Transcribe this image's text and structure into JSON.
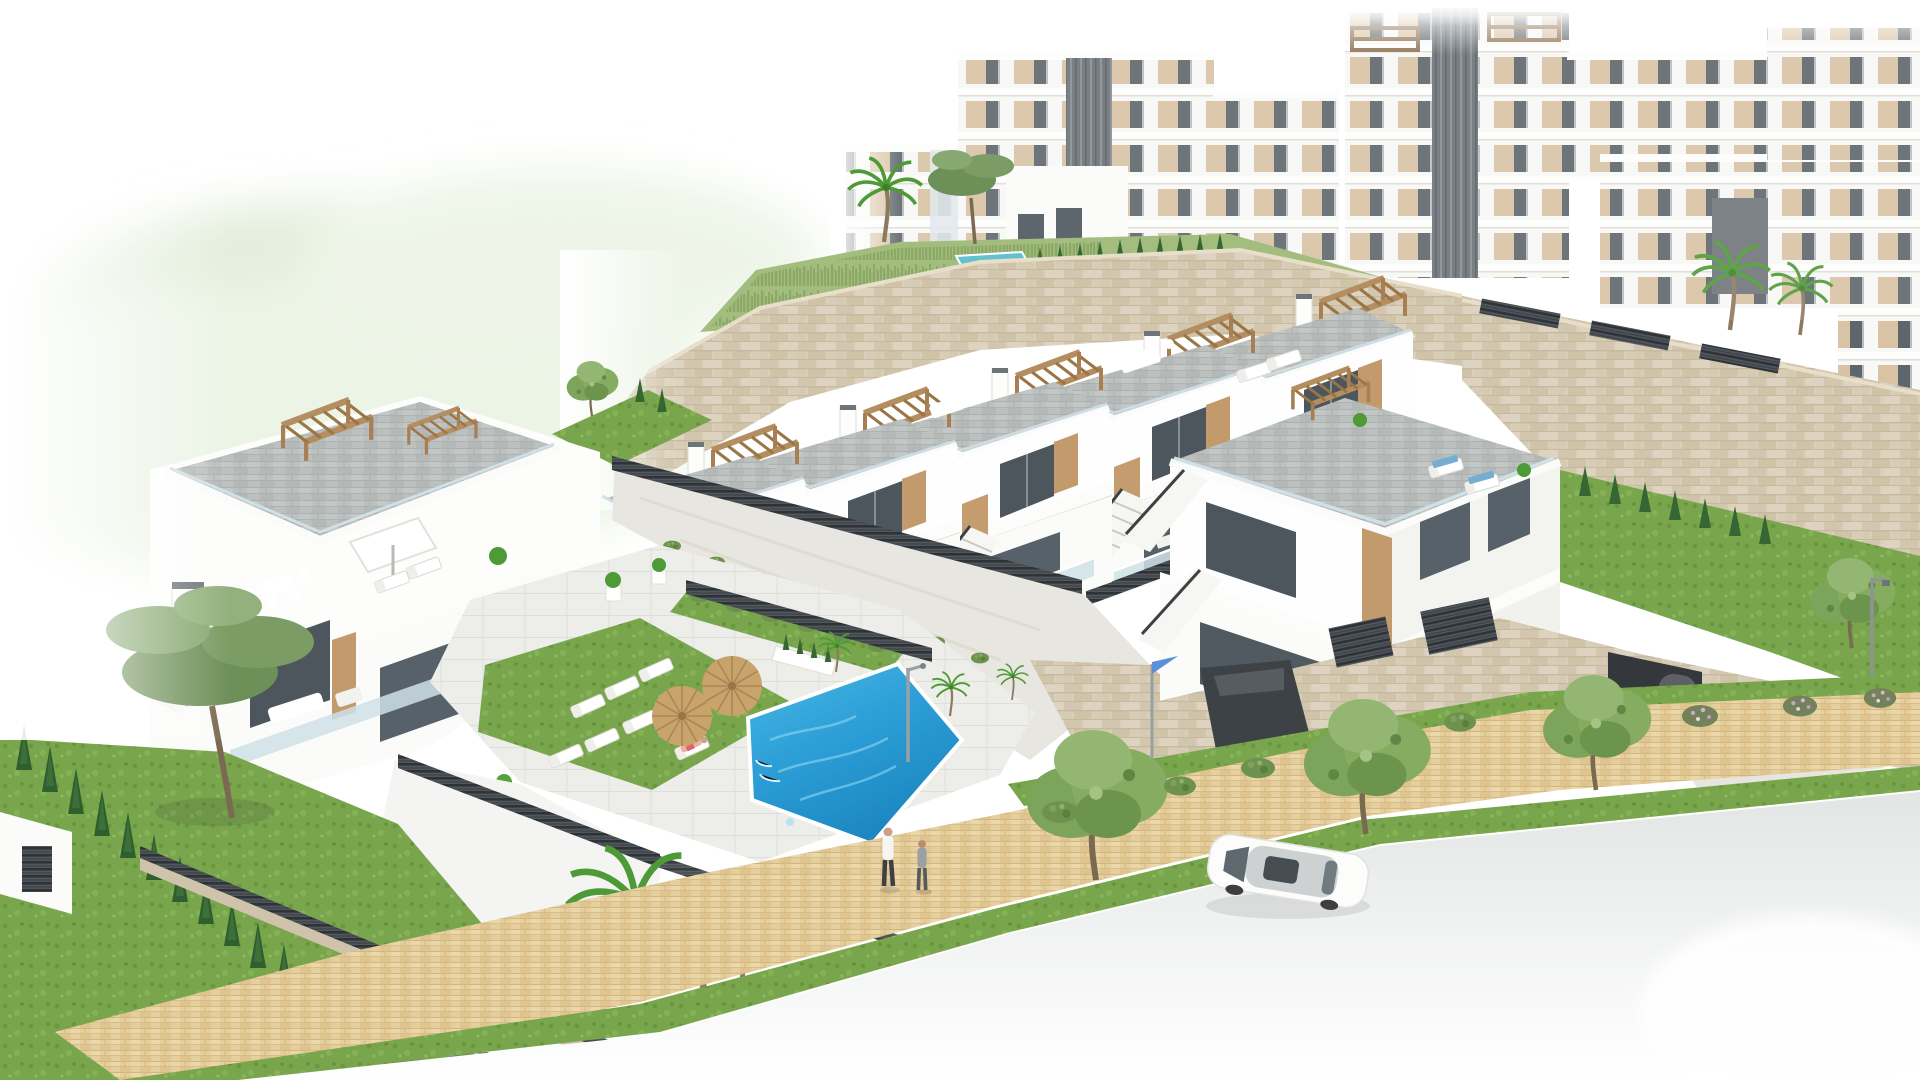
{
  "scene": {
    "type": "3d-architectural-render",
    "description": "Aerial rendering of a hillside residential development: terraced white townhouses with rooftop pergola terraces and external stairs, large white apartment blocks behind, a communal swimming pool with straw umbrellas and sun loungers, stone retaining walls, landscaped gardens, a paved sidewalk with two pedestrians, and a street with a white sedan and a dark coupe by a garage.",
    "objects": {
      "apartment_blocks": 4,
      "townhouse_units_mid_row": 5,
      "corner_villa": 1,
      "left_villa_duplex": 1,
      "communal_pool": 1,
      "small_garden_pool": 1,
      "straw_umbrellas": 2,
      "white_roof_umbrella": 1,
      "sun_loungers_at_pool": 7,
      "roof_loungers": 4,
      "pedestrians": 2,
      "white_sedan_on_road": 1,
      "dark_coupe_at_garage": 1,
      "palm_trees": 5,
      "pine_trees": 2,
      "cypress_hedge_rows": 2,
      "street_trees": 3,
      "street_lamps": 1,
      "flag_poles": 1
    },
    "palette": {
      "white": "#ffffff",
      "facade_shade": "#f1f1ef",
      "facade_dark": "#e2e2de",
      "glass_dark": "#525c63",
      "glass_mid": "#7d8992",
      "balustrade": "#cfe0e7",
      "wood": "#c39a6c",
      "wood_dark": "#a87f52",
      "pavers": "#bcc0be",
      "stone": "#d9cfba",
      "concrete_wall": "#e8e6e0",
      "fence": "#454b50",
      "lawn": "#79a64c",
      "lawn_dark": "#5e8c3d",
      "slope_grass": "#a3bd7e",
      "cypress": "#2f5f2e",
      "tree": "#7ca45b",
      "pine": "#6d8f58",
      "palm": "#4e9a36",
      "pool_light": "#46b9e6",
      "pool_deep": "#1b86c0",
      "small_pool": "#63c0cf",
      "path": "#e6cf9f",
      "path_joint": "#d2b77f",
      "road": "#e7e8e8",
      "umbrella_straw": "#c8a36a",
      "umbrella_rib": "#a9875a",
      "car_dark": "#5f6065",
      "skin": "#caa088",
      "flag_blue": "#5b8fd6",
      "beige_panel": "#d9c3a4"
    }
  }
}
